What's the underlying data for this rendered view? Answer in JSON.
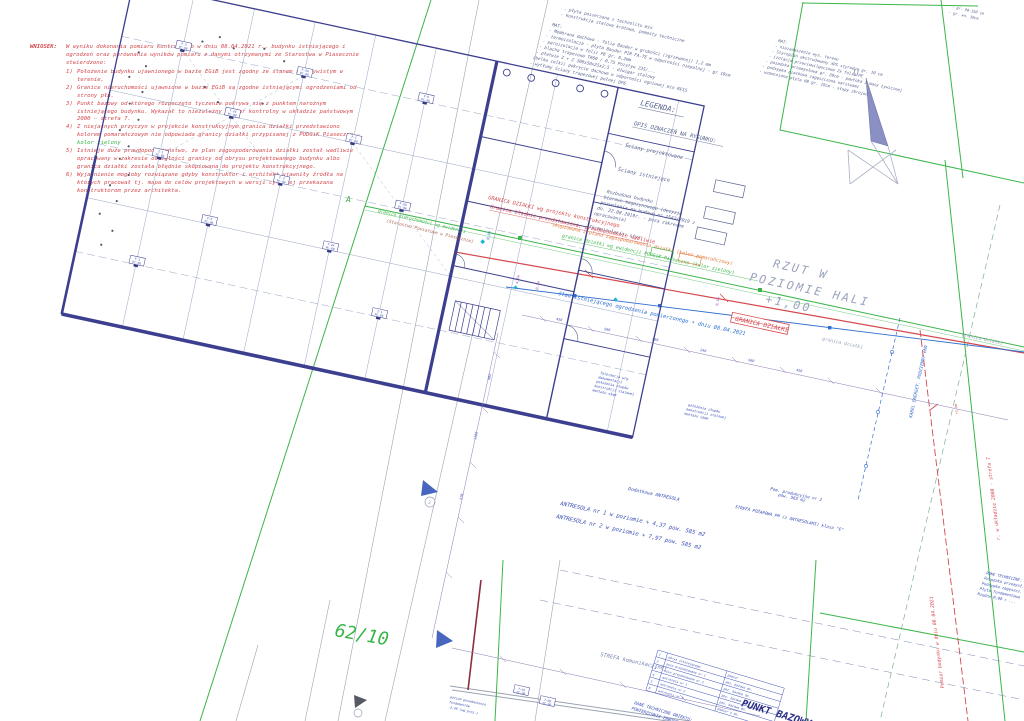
{
  "notes": {
    "label": "WNIOSEK:",
    "intro": "W wyniku dokonania pomiaru kontrolnego w dniu 08.04.2021 r., budynku istniejącego i ogrodzeń oraz porównania wyników pomiaru z danymi otrzymanymi ze Starostwa w Piasecznie stwierdzono:",
    "items": [
      {
        "n": "1)",
        "t": "Położenie budynku ujawnionego w bazie EGiB jest zgodny ze stanem rzeczywistym w terenie,"
      },
      {
        "n": "2)",
        "t": "Granice nieruchomości ujawnione w bazie EGiB są zgodne istniejącymi ogrodzeniami od strony płn."
      },
      {
        "n": "3)",
        "t": "Punkt bazowy od którego rozpoczęto tyczenie pokrywa się z punktem narożnym istniejącego budynku. Wykazał to niezależny pomiar kontrolny w układzie państwowym 2000 — strefa 7."
      },
      {
        "n": "4)",
        "t": "Z niejasnych przyczyn w projekcie konstrukcyjnym granica działki przedstawiono kolorem pomarańczowym nie odpowiada granicy działki przypisanej z PODGiK Piaseczno — ",
        "hl": "kolor zielony"
      },
      {
        "n": "5)",
        "t": "Istnieje duże prawdopodobieństwo, że plan zagospodarowania działki został wadliwie opracowany w zakresie odległości granicy od obrysu projektowanego budynku albo granica działki została błędnie skopiowana do projektu konstrukcyjnego."
      },
      {
        "n": "6)",
        "t": "Wyjaśnienie mogłoby rozwiązane gdyby konstruktor i architekt ujawniły źródła na których pracował tj. mapa do celów projektowych w wersji cyfrowej przekazana konstruktorom przez architekta."
      }
    ]
  },
  "legend": {
    "title": "LEGENDA:",
    "subtitle": "OPIS OZNACZEŃ NA RYSUNKU:",
    "entry1": "Ściany projektowane",
    "entry2": "Ściany istniejące",
    "entry3a": "Rozbudowa budynku",
    "entry3b": "biurowo-magazynowego (decyzja",
    "entry3c": "pozwolenia na budowę nr 1542/2019 z",
    "entry3d": "dn. 22.08.2019r. - poza zakresem",
    "entry3e": "opracowania)",
    "extra": "Termoizolacja: styr."
  },
  "boundary": {
    "red_title": "GRANICA DZIAŁKI wg projektu konstrukcyjnego",
    "red_sub": "Granica błędnie przedstawiona, prawdopodobnie wadliwie",
    "orange_note": "skopiowana z planu zagospodarowania działki (kolor pomarańczowy)",
    "green_note": "granica działki wg ewidencji PODGiK Piaseczno (kolor zielony)",
    "ewid_line1": "granica nieruchomości wg ewidencji",
    "ewid_line2": "(Starostwo Powiatowe w Piasecznie)",
    "fence": "ślad istniejącego ogrodzenia pomierzonego • dniu 08.04.2021",
    "granica_box": "GRANICA DZIAŁKI",
    "granica_small": "granica działki",
    "granica_small2": "granica działki",
    "marker_a": "A"
  },
  "titles": {
    "rzut1": "RZUT W",
    "rzut2": "POZIOMIE HALI",
    "rzut3": "+1,00",
    "parcel": "62/10",
    "strefa_kom": "STREFA komunikacyjnej",
    "punkt_bazowy": "PUNKT BAZOWY",
    "dane_obiekt1": "DANE TECHNICZNE OBIEKTU:",
    "dane_obiekt2": "POWIERZCHNIA ZABUDOWY"
  },
  "hala": {
    "antresola0": "Dodatkowa ANTRESOLA",
    "antresola1": "ANTRESOLA nr 1 w poziomie + 4,37   pow. 585 m2",
    "antresola2": "ANTRESOLA nr 2 w poziomie + 7,97   pow. 585 m2",
    "strefa_poz": "STREFA POŻAROWA PM (z ANTRESOLAMI) klasa \"E\"",
    "pom1": "Pom. produkcyjne nr 2",
    "pom2": "pow. 565 m2",
    "toler1": "Tolerancja w/g",
    "toler2": "dokumentacji",
    "toler3": "położenia słupów",
    "toler4": "konstrukcji stalowej",
    "toler5": "montażu ±5mm",
    "fund1": "poziom posadowienia",
    "fund2": "fundamentów",
    "fund3": "-3,20 (wg proj.)"
  },
  "roof": {
    "top1": "- płyta poszerzana z technolitu mix",
    "top2": "- konstrukcja stalowa kratowa, pomosty techniczne",
    "lines": [
      "MAT:",
      "- Membrana dachowa - folia Bauder w grubości (zgrzewanej) 1,2 mm",
      "- termoizolacja - płyta Bauder PIR FA-TE w odporności niepalnej - gr 10cm",
      "- paroizolacja w folii PE gr. 0,2mm",
      "- blacha trapezowa TR60 / 0,75 Pozytyw  235/...",
      "- płatwie Z + Z 300x50x25x2,5 - dźwigar stalowy",
      "(belka celki) pokrycie dachowe w odporności ogniowej min RE15",
      "- wytłumy ściany trapezowej pełnej DF6"
    ]
  },
  "found": {
    "lines": [
      "MAT:",
      "- niezadaszenie wys. terenu",
      "- Styropian ekstrudowany XPS styrodur gr. 10 cm",
      "- izolacja przeciwwilgociowa 2x folia PE",
      "- posadzka przemysłowa gr. 20cm - powłoka z masy żywicznej",
      "- podsypka piaskowa zagęszczona warstwami",
      "- wzmocniona płyta HB gr. 18cm - słupy zbrojone"
    ],
    "corner1": "- gr. 90-350 cm",
    "corner2": "- gr. wn. 30cm"
  },
  "east": {
    "kabel": "KABEL ENERGET. PODZIEMNY eNN",
    "pomiar_bud": "Pomiar budynku w dniu 08.04.2021",
    "uklad": "r. w układzie 2000 - strefa 7",
    "tick1": "+1,0m",
    "dane": [
      "DANE TECHNICZNE:",
      "Posadzka przemysł.",
      "Podsypka zagęszcz.",
      "Płyta fundamentowa",
      "Rzędna 0,00 = ..."
    ]
  },
  "table": {
    "rows": [
      {
        "c1": "1",
        "c2": "obrys istniejącego",
        "c3": "pomiar"
      },
      {
        "c1": "2",
        "c2": "osie projektowane nr 1",
        "c3": "poz. bazowa dn."
      },
      {
        "c1": "3",
        "c2": "osie projektowane nr 2",
        "c3": "poz. bazowa dn."
      },
      {
        "c1": "4",
        "c2": "antresola nr 1",
        "c3": "poz. bazowa dn."
      },
      {
        "c1": "5",
        "c2": "antresola nr 2",
        "c3": "poz. bazowa dn."
      },
      {
        "c1": "6",
        "c2": "antresola  nr 3",
        "c3": "pomiar z dn."
      }
    ]
  },
  "footings": {
    "f1a": "F-3",
    "f1b": "PC-06",
    "f2a": "F-5A",
    "f2b": "PC-06",
    "f3a": "F-6",
    "f3b": "PC-06",
    "f4a": "T-24",
    "f4b": "PC-08",
    "f5a": "F-1",
    "f5b": "PC-06",
    "f6a": "Z-1",
    "f6b": "PC-06",
    "t1a": "T-05",
    "t1b": "PC-06",
    "t2a": "T-06",
    "t2b": "PC-06"
  },
  "dims": {
    "d1": "450",
    "d2": "580",
    "d3": "560",
    "d4": "240",
    "d5": "580",
    "d6": "450",
    "v1": "602",
    "v2": "1185",
    "v3": "570",
    "m1": "4,5m",
    "m2": "0,5m",
    "m3": "0,5m",
    "m4": "0,9m"
  },
  "misc": {
    "u": "U",
    "s2": "2"
  }
}
